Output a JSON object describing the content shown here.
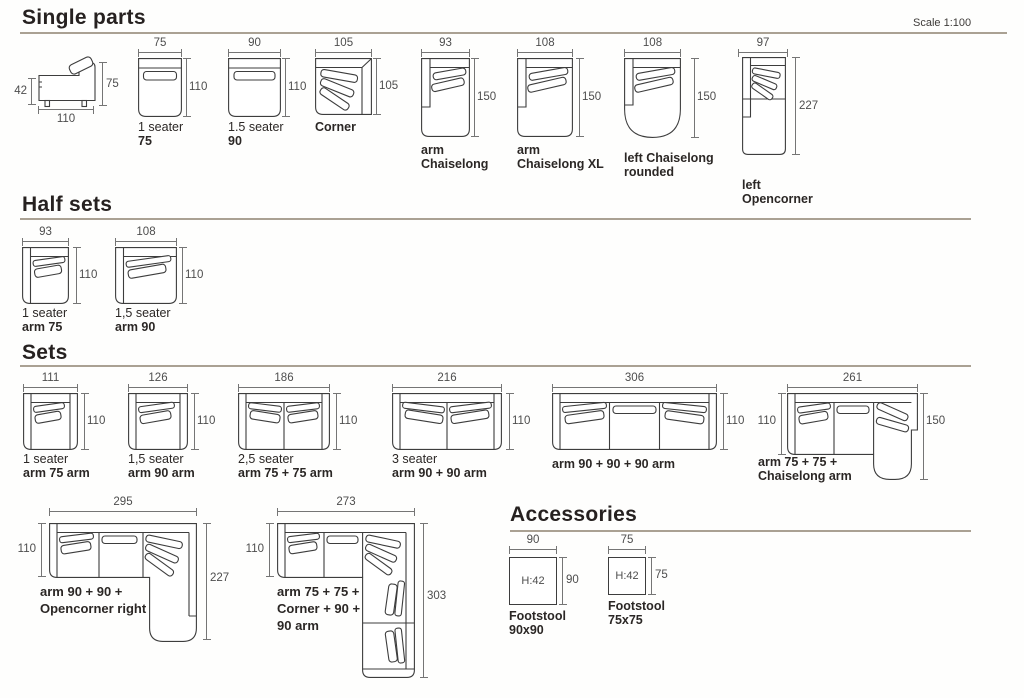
{
  "page": {
    "scale_note": "Scale 1:100"
  },
  "headings": {
    "single_parts": "Single parts",
    "half_sets": "Half sets",
    "sets": "Sets",
    "accessories": "Accessories"
  },
  "single_parts": {
    "side_view": {
      "seat_height": "42",
      "total_height": "75",
      "depth": "110"
    },
    "seater_75": {
      "width": "75",
      "depth": "110",
      "line1": "1 seater",
      "line2": "75"
    },
    "seater_90": {
      "width": "90",
      "depth": "110",
      "line1": "1.5 seater",
      "line2": "90"
    },
    "corner": {
      "width": "105",
      "depth": "105",
      "line1": "Corner"
    },
    "arm_chaiselong": {
      "width": "93",
      "depth": "150",
      "line1": "arm",
      "line2": "Chaiselong"
    },
    "arm_chaiselong_xl": {
      "width": "108",
      "depth": "150",
      "line1": "arm",
      "line2": "Chaiselong XL"
    },
    "left_chaiselong_rounded": {
      "width": "108",
      "depth": "150",
      "line1": "left Chaiselong",
      "line2": "rounded"
    },
    "left_opencorner": {
      "width": "97",
      "depth": "227",
      "line1": "left",
      "line2": "Opencorner"
    }
  },
  "half_sets": {
    "one_seater_arm75": {
      "width": "93",
      "depth": "110",
      "line1": "1 seater",
      "line2": "arm 75"
    },
    "one_half_seater_arm90": {
      "width": "108",
      "depth": "110",
      "line1": "1,5 seater",
      "line2": "arm 90"
    }
  },
  "sets": {
    "set_111": {
      "width": "111",
      "depth": "110",
      "line1": "1 seater",
      "line2": "arm 75 arm"
    },
    "set_126": {
      "width": "126",
      "depth": "110",
      "line1": "1,5 seater",
      "line2": "arm 90 arm"
    },
    "set_186": {
      "width": "186",
      "depth": "110",
      "line1": "2,5 seater",
      "line2": "arm 75 + 75 arm"
    },
    "set_216": {
      "width": "216",
      "depth": "110",
      "line1": "3 seater",
      "line2": "arm 90 + 90 arm"
    },
    "set_306": {
      "width": "306",
      "depth": "110",
      "line1": "arm 90 + 90 + 90 arm"
    },
    "set_261": {
      "width": "261",
      "depth_left": "110",
      "depth_right": "150",
      "line1": "arm 75 + 75 +",
      "line2": "Chaiselong arm"
    },
    "set_295": {
      "width": "295",
      "depth_left": "110",
      "depth_right": "227",
      "line1": "arm 90 + 90 +",
      "line2": "Opencorner right"
    },
    "set_273": {
      "width": "273",
      "depth_left": "110",
      "depth_right": "303",
      "line1": "arm 75 + 75 +",
      "line2": "Corner + 90 +",
      "line3": "90 arm"
    }
  },
  "accessories": {
    "footstool_90": {
      "width": "90",
      "depth": "90",
      "height_label": "H:42",
      "line1": "Footstool",
      "line2": "90x90"
    },
    "footstool_75": {
      "width": "75",
      "depth": "75",
      "height_label": "H:42",
      "line1": "Footstool",
      "line2": "75x75"
    }
  }
}
